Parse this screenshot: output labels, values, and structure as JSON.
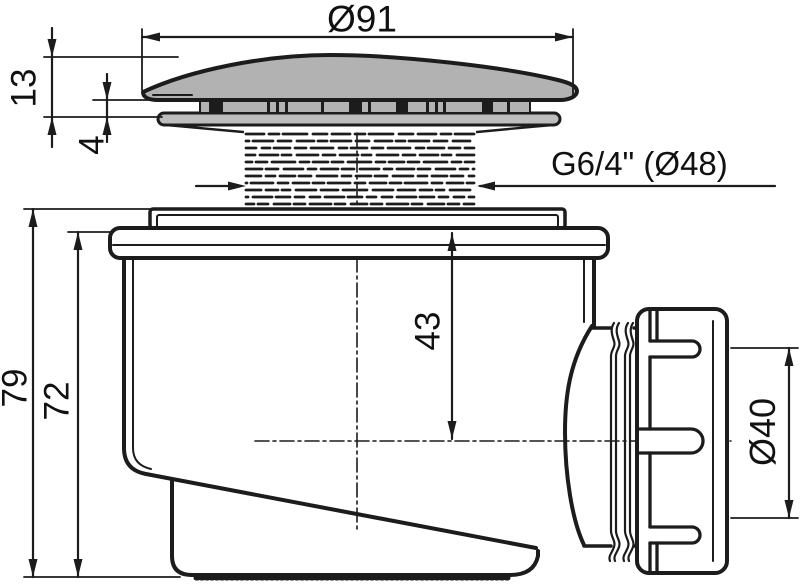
{
  "drawing": {
    "labels": {
      "cap_diameter": "Ø91",
      "cap_height": "13",
      "rim_gap": "4",
      "thread_spec": "G6/4\" (Ø48)",
      "overall_height": "79",
      "body_height": "72",
      "bowl_depth": "43",
      "outlet_diameter": "Ø40"
    },
    "colors": {
      "line": "#1c1c1c",
      "cap_fill": "#b2b2b2",
      "band_fill": "#bdbdbd",
      "background": "#ffffff"
    }
  }
}
